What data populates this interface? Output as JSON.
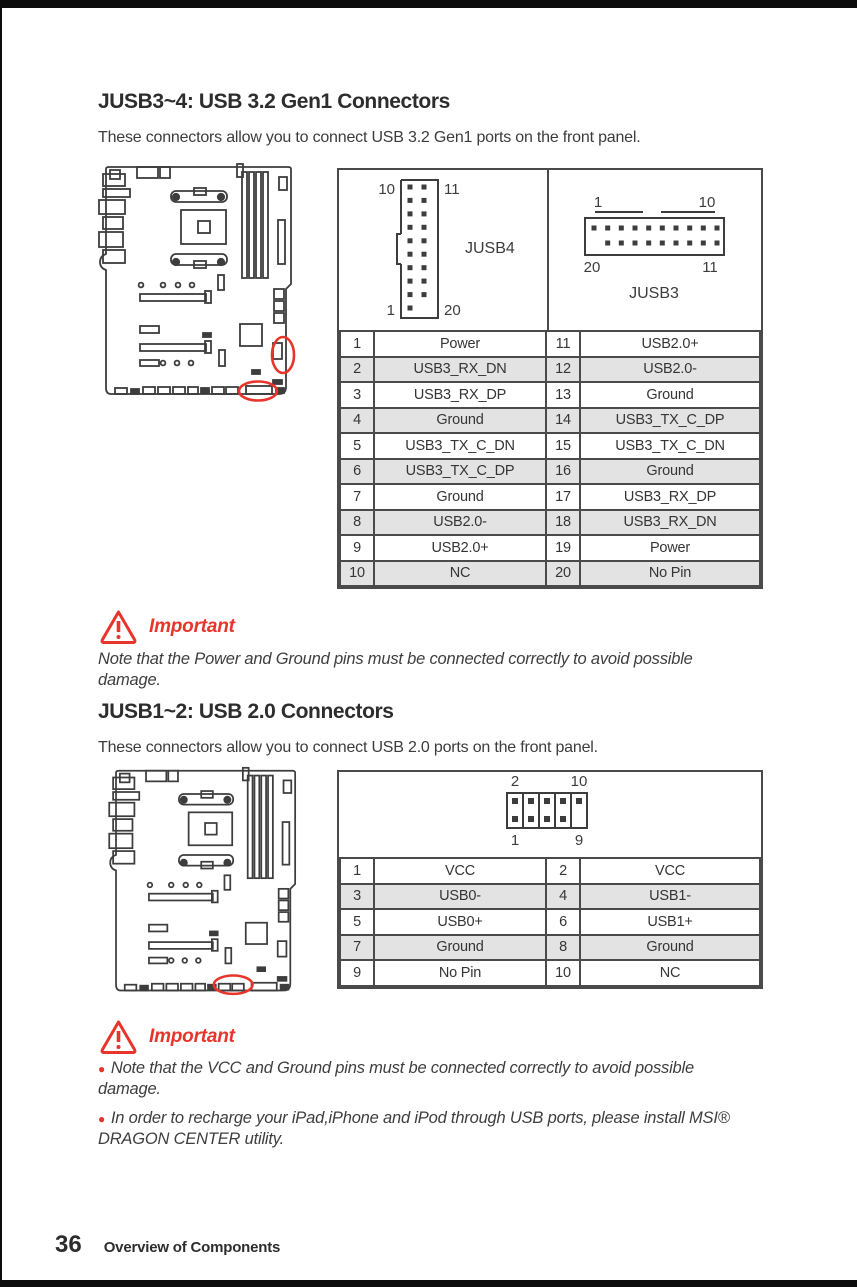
{
  "colors": {
    "accent_red": "#e8352b",
    "table_shaded": "#e3e3e3",
    "line_dark": "#4a4a4a"
  },
  "section1": {
    "title": "JUSB3~4: USB 3.2 Gen1 Connectors",
    "description": "These connectors allow you to connect USB 3.2 Gen1 ports on the front panel.",
    "jusb4": {
      "label": "JUSB4",
      "top_left": "10",
      "top_right": "11",
      "bottom_left": "1",
      "bottom_right": "20"
    },
    "jusb3": {
      "label": "JUSB3",
      "top_left": "1",
      "top_right": "10",
      "bottom_left": "20",
      "bottom_right": "11"
    },
    "pin_table": {
      "rows": [
        [
          "1",
          "Power",
          "11",
          "USB2.0+"
        ],
        [
          "2",
          "USB3_RX_DN",
          "12",
          "USB2.0-"
        ],
        [
          "3",
          "USB3_RX_DP",
          "13",
          "Ground"
        ],
        [
          "4",
          "Ground",
          "14",
          "USB3_TX_C_DP"
        ],
        [
          "5",
          "USB3_TX_C_DN",
          "15",
          "USB3_TX_C_DN"
        ],
        [
          "6",
          "USB3_TX_C_DP",
          "16",
          "Ground"
        ],
        [
          "7",
          "Ground",
          "17",
          "USB3_RX_DP"
        ],
        [
          "8",
          "USB2.0-",
          "18",
          "USB3_RX_DN"
        ],
        [
          "9",
          "USB2.0+",
          "19",
          "Power"
        ],
        [
          "10",
          "NC",
          "20",
          "No Pin"
        ]
      ]
    },
    "important": {
      "label": "Important",
      "notes": [
        "Note that the Power and Ground pins must be connected correctly to avoid possible damage."
      ]
    }
  },
  "section2": {
    "title": "JUSB1~2: USB 2.0 Connectors",
    "description": "These connectors allow you to connect USB 2.0 ports on the front panel.",
    "header": {
      "top_left": "2",
      "top_right": "10",
      "bottom_left": "1",
      "bottom_right": "9"
    },
    "pin_table": {
      "rows": [
        [
          "1",
          "VCC",
          "2",
          "VCC"
        ],
        [
          "3",
          "USB0-",
          "4",
          "USB1-"
        ],
        [
          "5",
          "USB0+",
          "6",
          "USB1+"
        ],
        [
          "7",
          "Ground",
          "8",
          "Ground"
        ],
        [
          "9",
          "No Pin",
          "10",
          "NC"
        ]
      ]
    },
    "important": {
      "label": "Important",
      "notes": [
        "Note that the VCC and Ground pins must be connected correctly to avoid possible damage.",
        "In order to recharge your iPad,iPhone and iPod through USB ports, please install MSI® DRAGON CENTER utility."
      ]
    }
  },
  "footer": {
    "page_number": "36",
    "text": "Overview of Components"
  }
}
